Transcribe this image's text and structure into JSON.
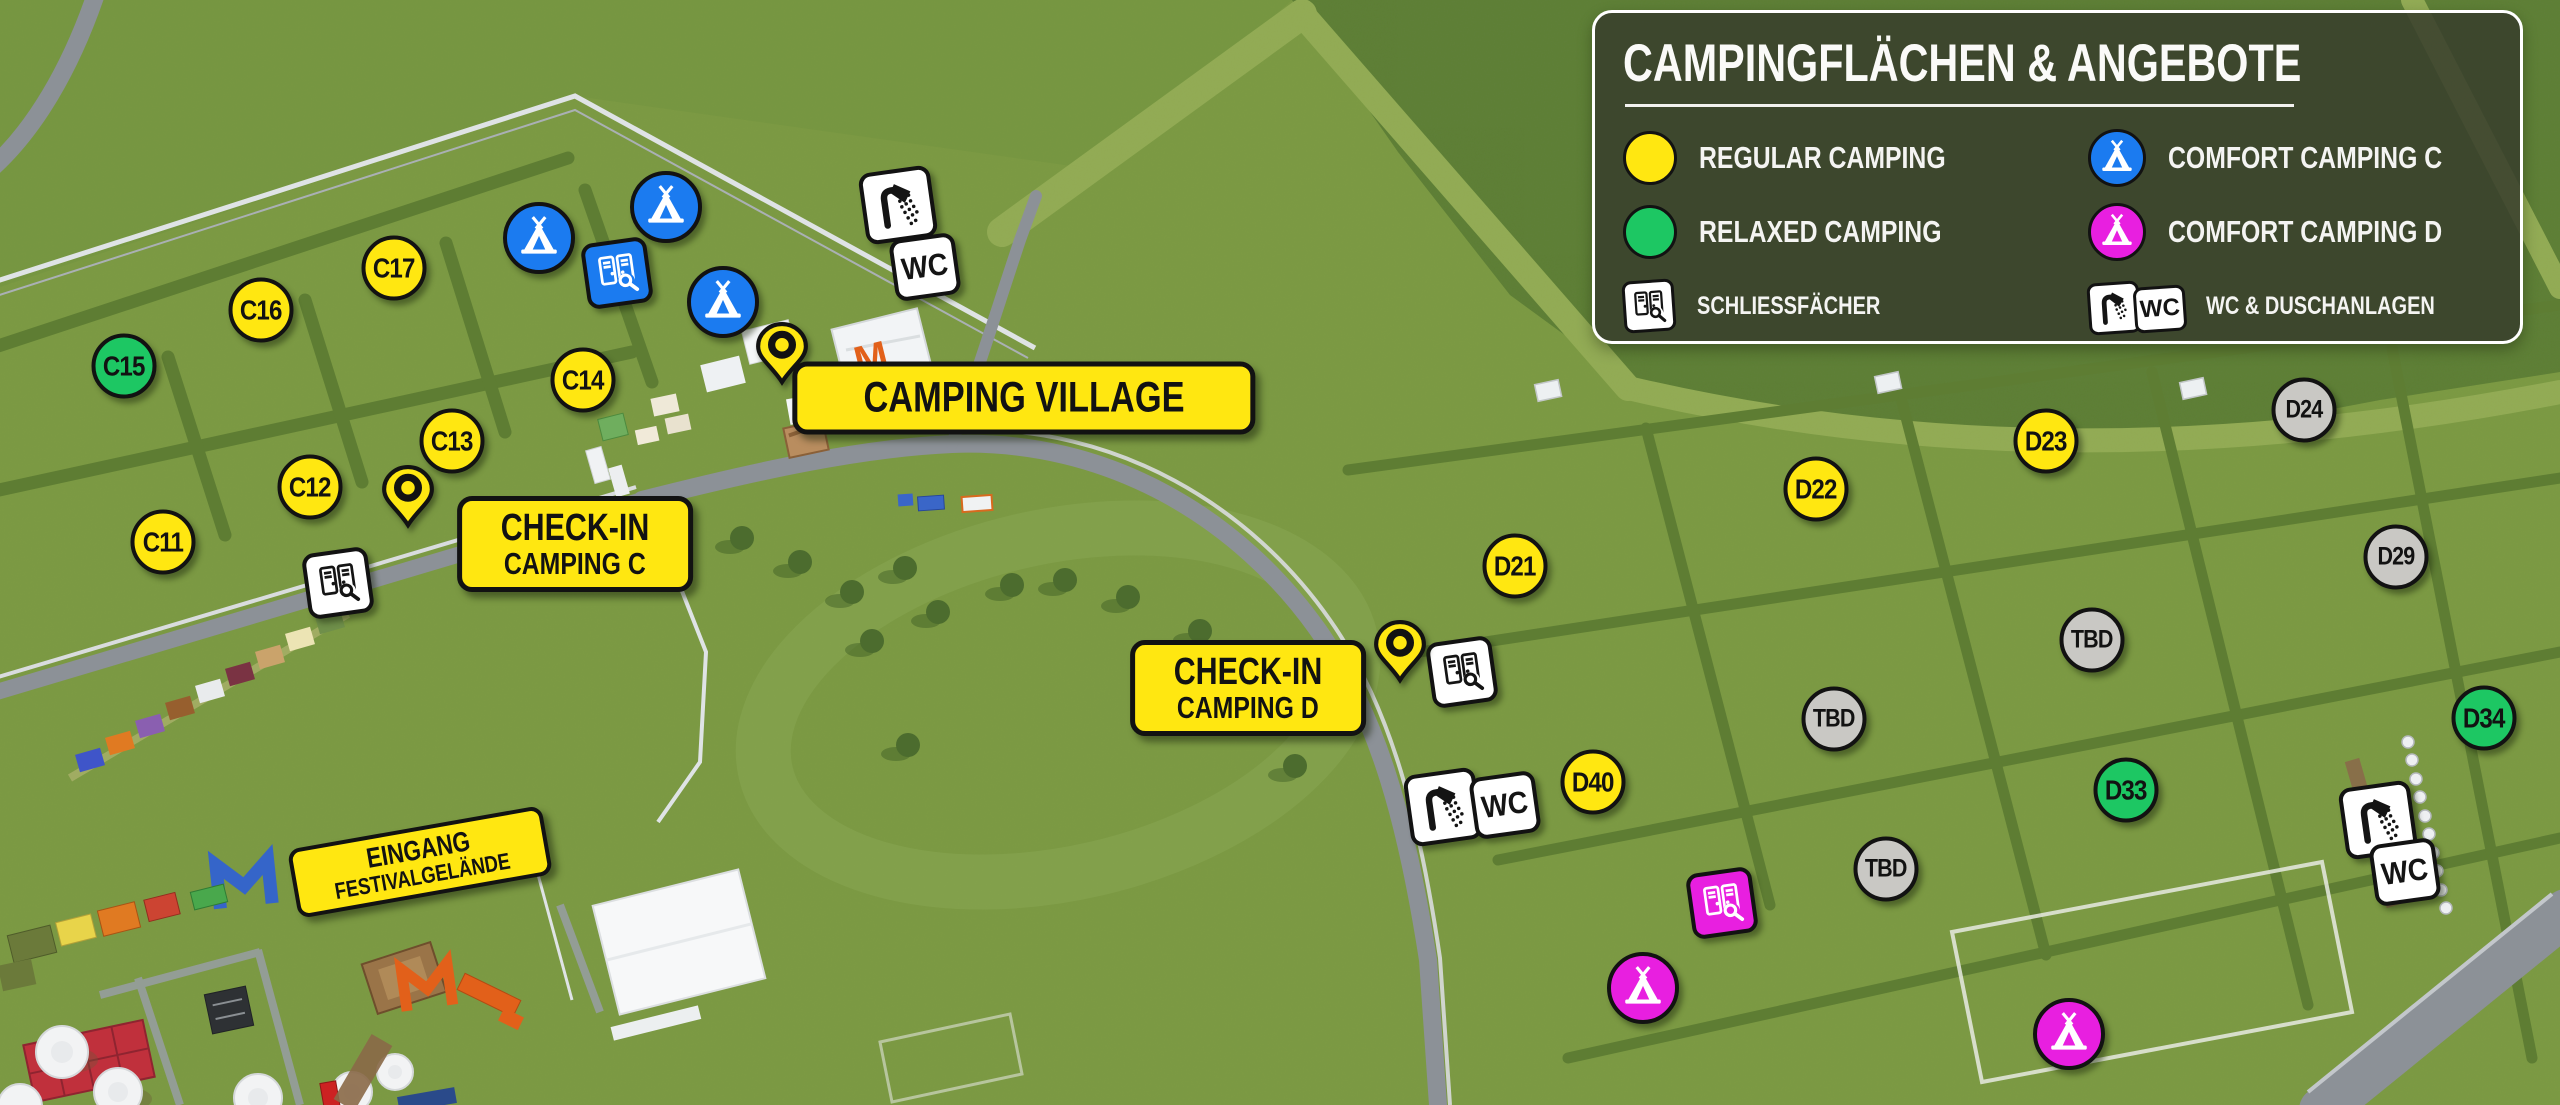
{
  "legend": {
    "title": "CAMPINGFLÄCHEN & ANGEBOTE",
    "items": [
      {
        "label": "REGULAR CAMPING",
        "swatch": "circle",
        "color_key": "regular"
      },
      {
        "label": "RELAXED CAMPING",
        "swatch": "circle",
        "color_key": "relaxed"
      },
      {
        "label": "COMFORT CAMPING C",
        "swatch": "tent",
        "color_key": "comfort_c"
      },
      {
        "label": "COMFORT CAMPING D",
        "swatch": "tent",
        "color_key": "comfort_d"
      }
    ],
    "facilities": [
      {
        "label": "SCHLIESSFÄCHER",
        "icon": "locker-icon"
      },
      {
        "label": "WC & DUSCHANLAGEN",
        "icon": "shower-wc-icon"
      }
    ]
  },
  "colors": {
    "regular": "#ffe711",
    "relaxed": "#1dc763",
    "comfort_c": "#1b7bf0",
    "comfort_d": "#e81fe0",
    "tbd": "#c9c8c4"
  },
  "map": {
    "wc_text": "WC",
    "m_logo": "M",
    "areas": [
      {
        "label": "C11",
        "type": "regular",
        "x": 163,
        "y": 542
      },
      {
        "label": "C12",
        "type": "regular",
        "x": 310,
        "y": 487
      },
      {
        "label": "C13",
        "type": "regular",
        "x": 452,
        "y": 441
      },
      {
        "label": "C14",
        "type": "regular",
        "x": 583,
        "y": 380
      },
      {
        "label": "C15",
        "type": "relaxed",
        "x": 124,
        "y": 366
      },
      {
        "label": "C16",
        "type": "regular",
        "x": 261,
        "y": 310
      },
      {
        "label": "C17",
        "type": "regular",
        "x": 394,
        "y": 268
      },
      {
        "label": "D21",
        "type": "regular",
        "x": 1515,
        "y": 566
      },
      {
        "label": "D22",
        "type": "regular",
        "x": 1816,
        "y": 489
      },
      {
        "label": "D23",
        "type": "regular",
        "x": 2046,
        "y": 441
      },
      {
        "label": "D24",
        "type": "tbd",
        "x": 2304,
        "y": 410
      },
      {
        "label": "D29",
        "type": "tbd",
        "x": 2396,
        "y": 557
      },
      {
        "label": "TBD",
        "type": "tbd",
        "x": 2092,
        "y": 640
      },
      {
        "label": "TBD",
        "type": "tbd",
        "x": 1834,
        "y": 719
      },
      {
        "label": "TBD",
        "type": "tbd",
        "x": 1886,
        "y": 869
      },
      {
        "label": "D33",
        "type": "relaxed",
        "x": 2126,
        "y": 790
      },
      {
        "label": "D34",
        "type": "relaxed",
        "x": 2484,
        "y": 718
      },
      {
        "label": "D40",
        "type": "regular",
        "x": 1593,
        "y": 782
      }
    ],
    "tents": [
      {
        "type": "comfort_c",
        "x": 539,
        "y": 238
      },
      {
        "type": "comfort_c",
        "x": 666,
        "y": 207
      },
      {
        "type": "comfort_c",
        "x": 723,
        "y": 302
      },
      {
        "type": "comfort_d",
        "x": 1643,
        "y": 988
      },
      {
        "type": "comfort_d",
        "x": 2069,
        "y": 1034
      }
    ],
    "lockers": [
      {
        "variant": "white",
        "x": 338,
        "y": 583
      },
      {
        "variant": "blue",
        "x": 617,
        "y": 273
      },
      {
        "variant": "white",
        "x": 1462,
        "y": 672
      },
      {
        "variant": "magenta",
        "x": 1722,
        "y": 903
      }
    ],
    "sanitary": [
      {
        "x": 898,
        "y": 205,
        "wc_dx": 27,
        "wc_dy": 62
      },
      {
        "x": 1443,
        "y": 807,
        "wc_dx": 62,
        "wc_dy": -2
      },
      {
        "x": 2378,
        "y": 820,
        "wc_dx": 27,
        "wc_dy": 52
      }
    ],
    "pins": [
      {
        "x": 782,
        "y": 385
      },
      {
        "x": 408,
        "y": 528
      },
      {
        "x": 1400,
        "y": 683
      }
    ],
    "callouts": [
      {
        "id": "camping-village",
        "lines": [
          "CAMPING VILLAGE"
        ],
        "x": 1024,
        "y": 398,
        "rotate": 0,
        "size": "lg"
      },
      {
        "id": "check-in-c",
        "lines": [
          "CHECK-IN",
          "CAMPING C"
        ],
        "x": 575,
        "y": 544,
        "rotate": 0,
        "size": "md"
      },
      {
        "id": "check-in-d",
        "lines": [
          "CHECK-IN",
          "CAMPING D"
        ],
        "x": 1248,
        "y": 688,
        "rotate": 0,
        "size": "md"
      },
      {
        "id": "eingang",
        "lines": [
          "EINGANG",
          "FESTIVALGELÄNDE"
        ],
        "x": 420,
        "y": 862,
        "rotate": -10,
        "size": "sm"
      }
    ]
  }
}
